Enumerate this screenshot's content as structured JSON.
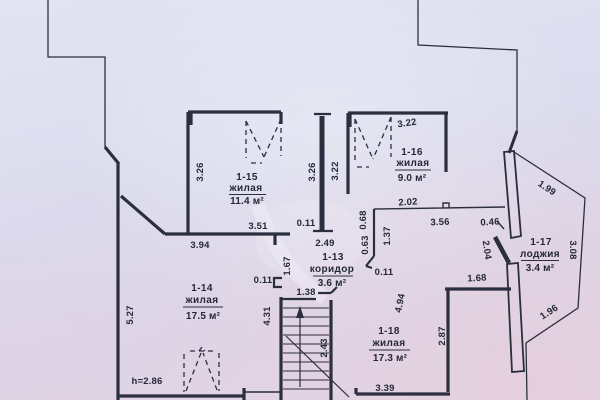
{
  "plan": {
    "rooms": [
      {
        "id": "1-15",
        "type": "жилая",
        "area": "11.4 м²"
      },
      {
        "id": "1-16",
        "type": "жилая",
        "area": "9.0 м²"
      },
      {
        "id": "1-13",
        "type": "коридор",
        "area": "3.6 м²"
      },
      {
        "id": "1-14",
        "type": "жилая",
        "area": "17.5 м²"
      },
      {
        "id": "1-18",
        "type": "жилая",
        "area": "17.3 м²"
      },
      {
        "id": "1-17",
        "type": "лоджия",
        "area": "3.4 м²"
      }
    ],
    "dims": {
      "r15_left": "3.26",
      "r15_bottom": "3.51",
      "r15_gap": "0.11",
      "r14_top": "3.94",
      "corridor_top": "2.49",
      "pier_left": "3.26",
      "pier_right": "3.22",
      "r16_top": "3.22",
      "r16_bottom": "2.02",
      "wall_068": "0.68",
      "wall_063": "0.63",
      "wall_137": "1.37",
      "r18_top": "3.56",
      "r18_top_right": "0.46",
      "loggia_top": "1.99",
      "loggia_right": "3.08",
      "loggia_bottom": "1.96",
      "loggia_door": "2.04",
      "r18_upper_right": "1.68",
      "corridor_right_gap": "0.11",
      "corridor_left_gap": "0.11",
      "corridor_left_height": "1.67",
      "stair_width": "1.38",
      "stair_left": "4.31",
      "stair_right": "2.43",
      "r18_left": "4.94",
      "r18_right": "2.87",
      "r18_bottom": "3.39",
      "r14_left": "5.27",
      "ceiling_height": "h=2.86"
    },
    "colors": {
      "paper": "#dcdded",
      "ink": "#2b2e3e"
    }
  }
}
